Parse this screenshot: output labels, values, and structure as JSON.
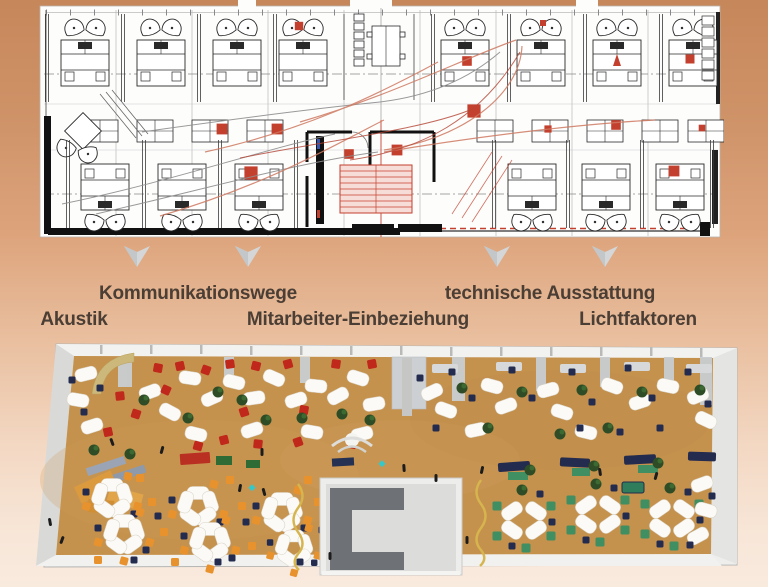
{
  "figure": {
    "type": "office-floorplan-comparison-diagram",
    "panels": {
      "top": "cad-floor-plan-drawing",
      "bottom": "3d-rendered-office-floor-plan"
    },
    "annotation_labels": {
      "kommunikationswege": "Kommunikationswege",
      "technische_ausstattung": "technische Ausstattung",
      "akustik": "Akustik",
      "mitarbeiter_einbeziehung": "Mitarbeiter-Einbeziehung",
      "lichtfaktoren": "Lichtfaktoren"
    },
    "icons": [
      "down-arrow-icon",
      "down-arrow-icon",
      "down-arrow-icon",
      "down-arrow-icon"
    ],
    "colors": {
      "background_top": "#c6875a",
      "background_bottom": "#f9eade",
      "label_text": "#4b3e35",
      "arrow_gray": "#d4d6d7",
      "plan_paper": "#fdfdfc",
      "plan_ink": "#2a2a2a",
      "plan_accent_red": "#c4402e",
      "plan_curve_salmon": "#cf7a62",
      "floor_tan": "#c5924e",
      "chair_red": "#c0281c",
      "chair_navy": "#232b4e",
      "accent_orange": "#e8922e",
      "accent_green": "#3f8f63",
      "plant_green": "#2e4d26",
      "core_dark_gray": "#6e7176",
      "core_light_gray": "#dcdcda",
      "squiggle_gold": "#d6b54e"
    }
  }
}
